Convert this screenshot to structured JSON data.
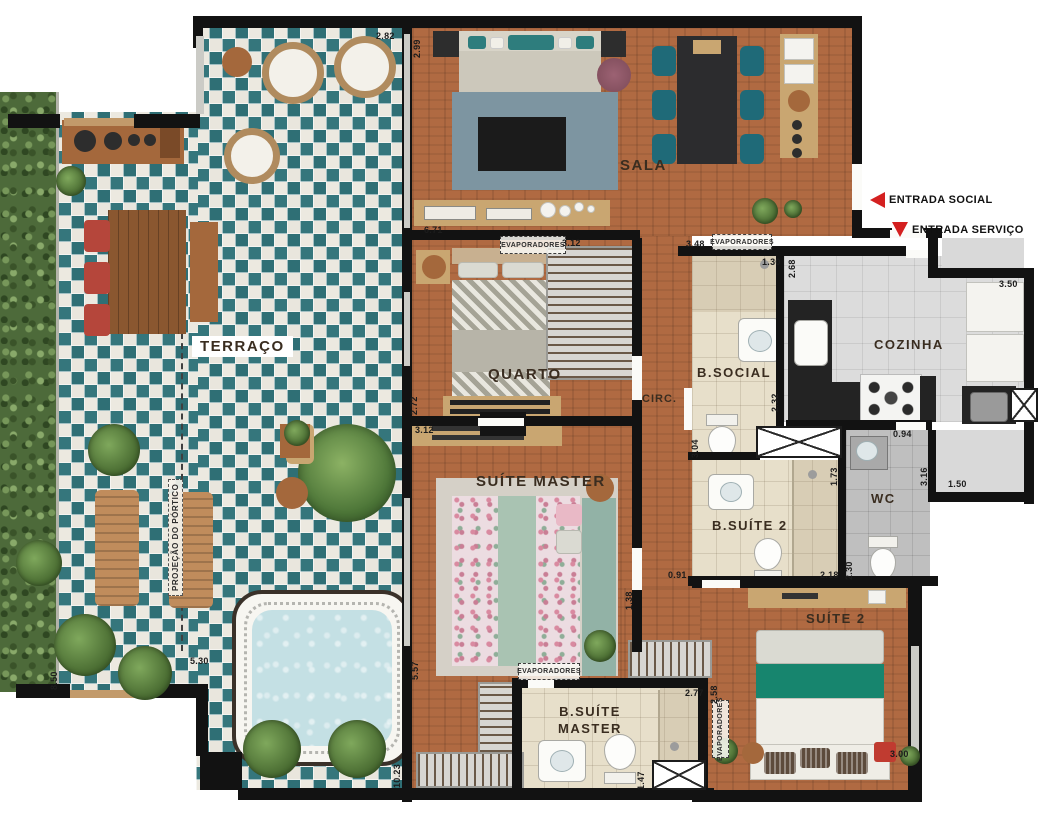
{
  "plan": {
    "rooms": [
      {
        "id": "terraco",
        "label": "TERRAÇO"
      },
      {
        "id": "sala",
        "label": "SALA"
      },
      {
        "id": "quarto",
        "label": "QUARTO"
      },
      {
        "id": "suite-master",
        "label": "SUÍTE MASTER"
      },
      {
        "id": "circ",
        "label": "CIRC."
      },
      {
        "id": "b-social",
        "label": "B.SOCIAL"
      },
      {
        "id": "cozinha",
        "label": "COZINHA"
      },
      {
        "id": "wc",
        "label": "WC"
      },
      {
        "id": "b-suite-2",
        "label": "B.SUÍTE 2"
      },
      {
        "id": "suite-2",
        "label": "SUÍTE 2"
      },
      {
        "id": "b-suite-master",
        "label": "B.SUÍTE MASTER"
      }
    ],
    "entrances": [
      {
        "label": "ENTRADA SOCIAL",
        "arrow": "left"
      },
      {
        "label": "ENTRADA SERVIÇO",
        "arrow": "down"
      }
    ],
    "annotations": {
      "evaporadores": "EVAPORADORES",
      "portico": "PROJEÇÃO DO PÓRTICO"
    },
    "dimensions": [
      "2.82",
      "2.99",
      "6.71",
      "3.12",
      "2.72",
      "3.12",
      "5.57",
      "3.48",
      "1.30",
      "2.32",
      "2.68",
      "3.50",
      "0.94",
      "3.16",
      "1.50",
      "3.04",
      "1.73",
      "2.18",
      "2.30",
      "0.91",
      "1.38",
      "2.58",
      "2.77",
      "3.00",
      "1.47",
      "8.50",
      "5.30",
      "10.23"
    ],
    "colors": {
      "tile_teal": "#2f6f75",
      "tile_base": "#eae7de",
      "wood_floor": "#b06a42",
      "wall": "#121212",
      "arrow_red": "#d42020",
      "pool_water": "#c4e0e4",
      "accent_teal": "#1f6a78",
      "accent_red": "#b5463b",
      "hedge_green": "#4d6a3a"
    }
  }
}
